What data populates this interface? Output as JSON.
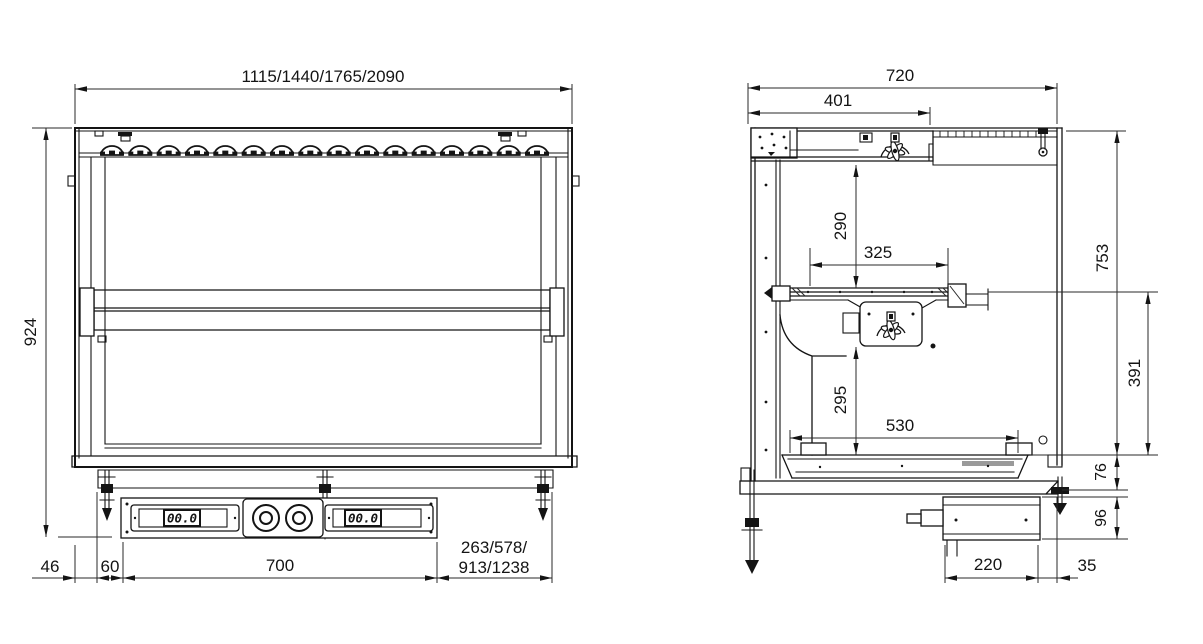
{
  "drawing": {
    "front": {
      "dims": {
        "overall_widths": "1115/1440/1765/2090",
        "overall_height": "924",
        "left_offset": "46",
        "bracket_gap": "60",
        "control_panel_width": "700",
        "right_offset_line1": "263/578/",
        "right_offset_line2": "913/1238"
      },
      "controls": {
        "left_display": "00.0",
        "right_display": "00.0"
      }
    },
    "side": {
      "dims": {
        "overall_depth": "720",
        "top_unit_depth": "401",
        "top_clearance": "290",
        "shelf_depth": "325",
        "glass_height": "753",
        "under_shelf_clearance": "295",
        "lower_clearance": "391",
        "well_depth": "530",
        "base_frame_height": "76",
        "control_box_height": "96",
        "control_box_depth": "220",
        "control_box_offset": "35"
      }
    }
  }
}
